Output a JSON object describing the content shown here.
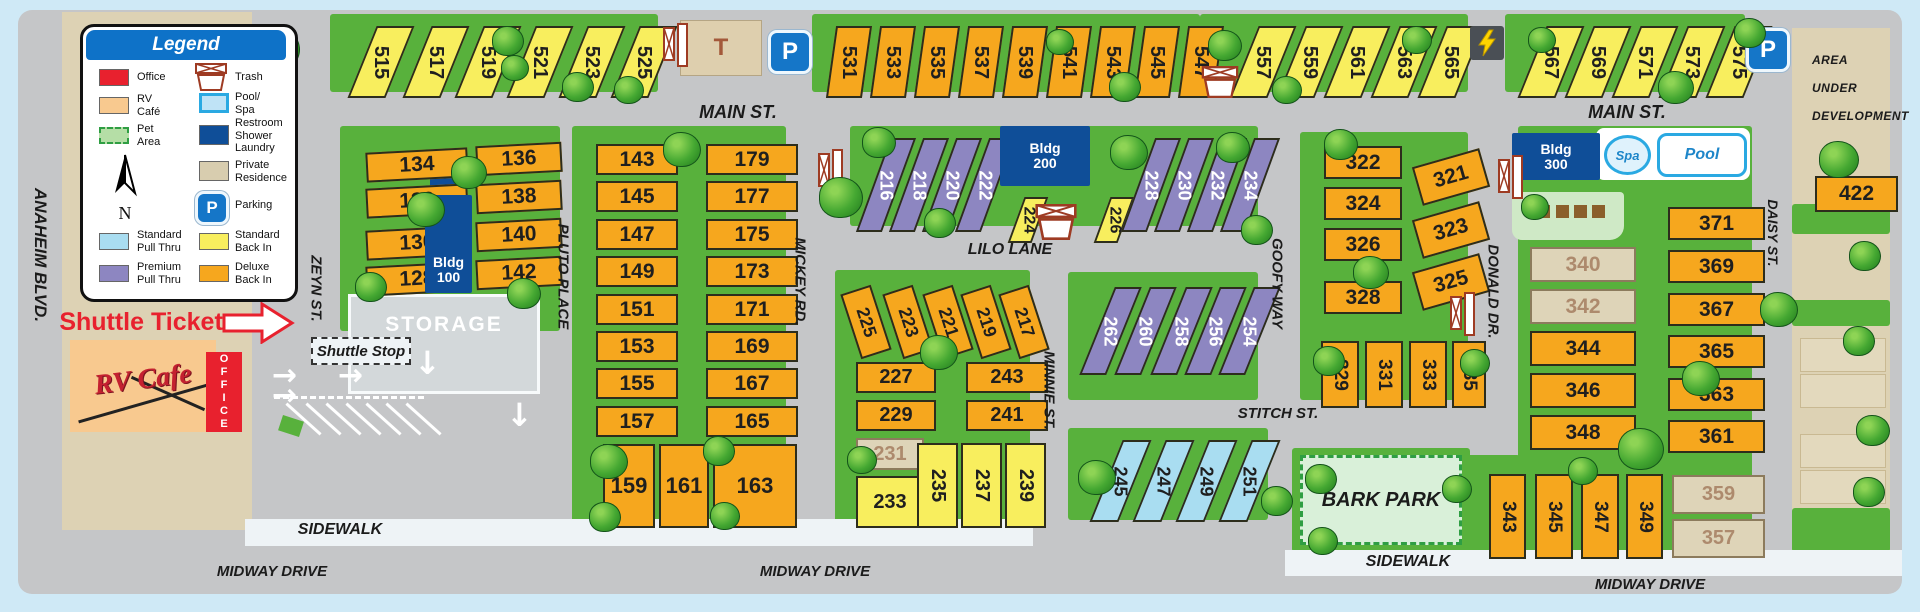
{
  "legend": {
    "title": "Legend",
    "compass_label": "N",
    "items": [
      {
        "label": "Office",
        "swatch": "office"
      },
      {
        "label": "Trash",
        "swatch": "trash"
      },
      {
        "label": "RV\nCafé",
        "swatch": "rv_cafe"
      },
      {
        "label": "Pool/\nSpa",
        "swatch": "pool_spa"
      },
      {
        "label": "Pet\nArea",
        "swatch": "pet_area"
      },
      {
        "label": "Restroom\nShower\nLaundry",
        "swatch": "restroom_shower_laundry"
      },
      {
        "label": "Private\nResidence",
        "swatch": "private_residence"
      },
      {
        "label": "Parking",
        "swatch": "parking"
      },
      {
        "label": "Standard\nPull Thru",
        "swatch": "standard_pull_thru"
      },
      {
        "label": "Standard\nBack In",
        "swatch": "standard_back_in"
      },
      {
        "label": "Premium\nPull Thru",
        "swatch": "premium_pull_thru"
      },
      {
        "label": "Deluxe\nBack In",
        "swatch": "deluxe_back_in"
      }
    ]
  },
  "streets": {
    "anaheim_blvd": "ANAHEIM BLVD.",
    "zeyn": "ZEYN  ST.",
    "pluto": "PLUTO  PLACE",
    "mickey": "MICKEY  RD.",
    "minnie": "MINNIE  ST.",
    "goofy": "GOOFY  WAY",
    "donald": "DONALD  DR.",
    "daisy": "DAISY  ST.",
    "main_st": "MAIN ST.",
    "lilo": "LILO LANE",
    "stitch": "STITCH ST.",
    "midway": "MIDWAY DRIVE",
    "sidewalk": "SIDEWALK"
  },
  "labels": {
    "shuttle_tickets": "Shuttle Tickets",
    "shuttle_stop": "Shuttle Stop",
    "storage": "STORAGE",
    "rv_cafe": "RV Cafe",
    "office": "OFFICE",
    "t_building": "T",
    "parking_p": "P",
    "bldg_100": "Bldg\n100",
    "bldg_200": "Bldg\n200",
    "bldg_300": "Bldg\n300",
    "spa": "Spa",
    "pool": "Pool",
    "bark_park": "BARK PARK",
    "area_under_development": "AREA\nUNDER\nDEVELOPMENT"
  },
  "colors": {
    "office_red": "#e8212e",
    "deluxe_back_in_orange": "#f6a71e",
    "standard_back_in_yellow": "#f8ee5e",
    "premium_pull_thru_purple": "#8d86c1",
    "standard_pull_thru_blue": "#a9ddf1",
    "private_residence_beige": "#ded4b8",
    "building_blue": "#0f4e98",
    "legend_header_blue": "#0e72c8",
    "map_green": "#58b13c",
    "pool_spa_border_blue": "#2aa9e2"
  },
  "site_groups": [
    {
      "name": "sites-515-525",
      "type": "standard_back_in",
      "numbers": [
        "515",
        "517",
        "519",
        "521",
        "523",
        "525"
      ]
    },
    {
      "name": "sites-531-547",
      "type": "deluxe_back_in",
      "numbers": [
        "531",
        "533",
        "535",
        "537",
        "539",
        "541",
        "543",
        "545",
        "547"
      ]
    },
    {
      "name": "sites-557-565",
      "type": "standard_back_in",
      "numbers": [
        "557",
        "559",
        "561",
        "563",
        "565"
      ]
    },
    {
      "name": "sites-567-575",
      "type": "standard_back_in",
      "numbers": [
        "567",
        "569",
        "571",
        "573",
        "575"
      ]
    },
    {
      "name": "sites-128-134",
      "type": "deluxe_back_in",
      "numbers": [
        "134",
        "132",
        "130",
        "128"
      ]
    },
    {
      "name": "sites-136-142",
      "type": "deluxe_back_in",
      "numbers": [
        "136",
        "138",
        "140",
        "142"
      ]
    },
    {
      "name": "sites-143-157",
      "type": "deluxe_back_in",
      "numbers": [
        "143",
        "145",
        "147",
        "149",
        "151",
        "153",
        "155",
        "157"
      ]
    },
    {
      "name": "sites-165-179",
      "type": "deluxe_back_in",
      "numbers": [
        "179",
        "177",
        "175",
        "173",
        "171",
        "169",
        "167",
        "165"
      ]
    },
    {
      "name": "sites-159-163",
      "type": "deluxe_back_in",
      "numbers": [
        "159",
        "161",
        "163"
      ]
    },
    {
      "name": "sites-216-222",
      "type": "premium_pull_thru",
      "numbers": [
        "216",
        "218",
        "220",
        "222"
      ]
    },
    {
      "name": "sites-224-226",
      "type": "standard_back_in",
      "numbers": [
        "224",
        "226"
      ]
    },
    {
      "name": "sites-228-234",
      "type": "premium_pull_thru",
      "numbers": [
        "228",
        "230",
        "232",
        "234"
      ]
    },
    {
      "name": "sites-217-225",
      "type": "deluxe_back_in",
      "numbers": [
        "225",
        "223",
        "221",
        "219",
        "217"
      ]
    },
    {
      "name": "sites-227-229",
      "type": "deluxe_back_in",
      "numbers": [
        "227",
        "229"
      ]
    },
    {
      "name": "sites-241-243",
      "type": "deluxe_back_in",
      "numbers": [
        "243",
        "241"
      ]
    },
    {
      "name": "site-231",
      "type": "private_residence",
      "numbers": [
        "231"
      ]
    },
    {
      "name": "site-233",
      "type": "standard_back_in",
      "numbers": [
        "233"
      ]
    },
    {
      "name": "sites-235-239",
      "type": "standard_back_in",
      "numbers": [
        "235",
        "237",
        "239"
      ]
    },
    {
      "name": "sites-254-262",
      "type": "premium_pull_thru",
      "numbers": [
        "262",
        "260",
        "258",
        "256",
        "254"
      ]
    },
    {
      "name": "sites-245-251",
      "type": "standard_pull_thru",
      "numbers": [
        "245",
        "247",
        "249",
        "251"
      ]
    },
    {
      "name": "sites-322-328",
      "type": "deluxe_back_in",
      "numbers": [
        "322",
        "324",
        "326",
        "328"
      ]
    },
    {
      "name": "sites-321-325",
      "type": "deluxe_back_in",
      "numbers": [
        "321",
        "323",
        "325"
      ]
    },
    {
      "name": "sites-329-335",
      "type": "deluxe_back_in",
      "numbers": [
        "329",
        "331",
        "333",
        "335"
      ]
    },
    {
      "name": "sites-340-342",
      "type": "private_residence",
      "numbers": [
        "340",
        "342"
      ]
    },
    {
      "name": "sites-344-348",
      "type": "deluxe_back_in",
      "numbers": [
        "344",
        "346",
        "348"
      ]
    },
    {
      "name": "sites-361-371",
      "type": "deluxe_back_in",
      "numbers": [
        "371",
        "369",
        "367",
        "365",
        "363",
        "361"
      ]
    },
    {
      "name": "sites-343-349",
      "type": "deluxe_back_in",
      "numbers": [
        "343",
        "345",
        "347",
        "349"
      ]
    },
    {
      "name": "sites-357-359",
      "type": "private_residence",
      "numbers": [
        "359",
        "357"
      ]
    },
    {
      "name": "site-422",
      "type": "deluxe_back_in",
      "numbers": [
        "422"
      ]
    }
  ]
}
